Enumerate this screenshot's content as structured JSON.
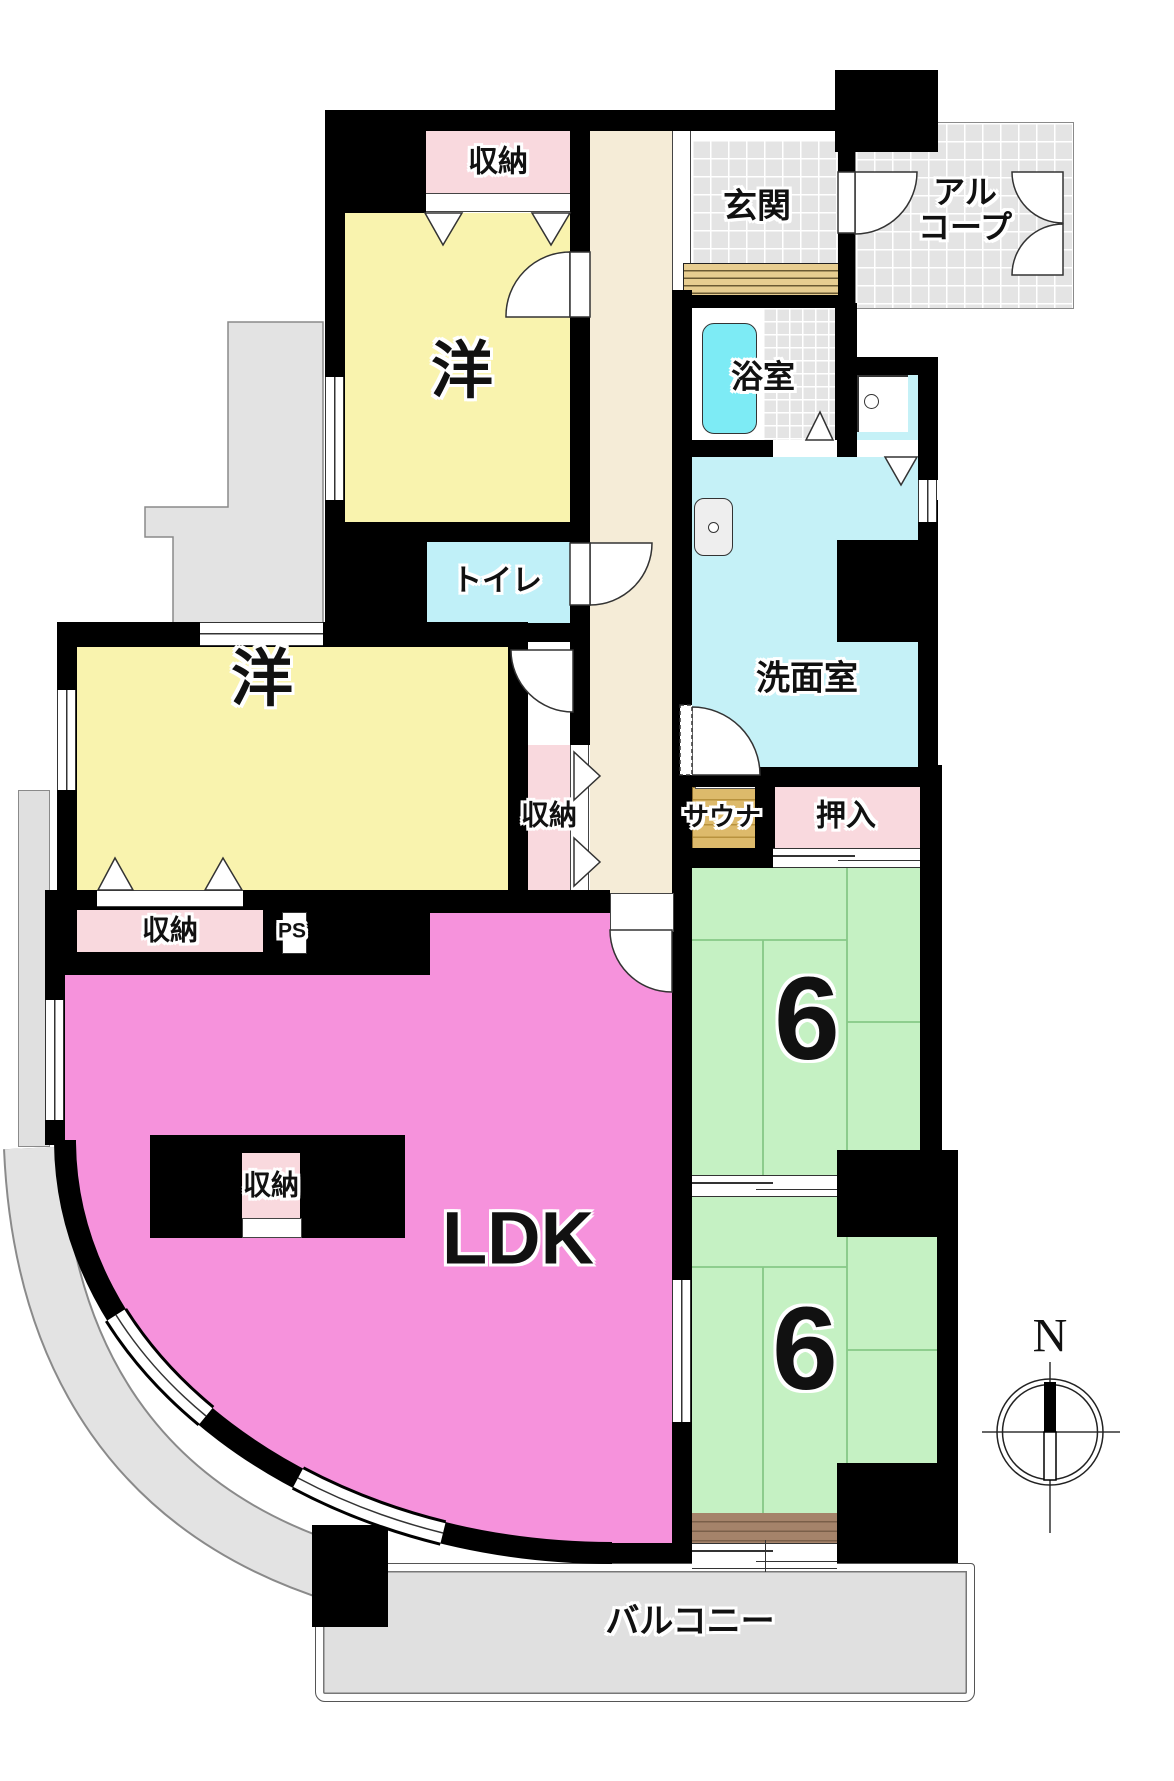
{
  "title": "マンション間取り図 (apartment floor plan)",
  "compass": {
    "label": "N"
  },
  "rooms": {
    "storage_top": {
      "label": "収納"
    },
    "western_north": {
      "label": "洋"
    },
    "entrance": {
      "label": "玄関"
    },
    "alcove": {
      "label_line1": "アル",
      "label_line2": "コープ"
    },
    "bathroom": {
      "label": "浴室"
    },
    "toilet": {
      "label": "トイレ"
    },
    "washroom": {
      "label": "洗面室"
    },
    "sauna": {
      "label": "サウナ"
    },
    "oshiire": {
      "label": "押入"
    },
    "storage_west_wall": {
      "label": "収納"
    },
    "western_center": {
      "label": "洋"
    },
    "storage_south": {
      "label": "収納"
    },
    "pipe_space": {
      "label": "PS"
    },
    "storage_ldk": {
      "label": "収納"
    },
    "ldk": {
      "label": "LDK"
    },
    "tatami_north": {
      "label": "6",
      "tatami_mats": 6
    },
    "tatami_south": {
      "label": "6",
      "tatami_mats": 6
    },
    "balcony": {
      "label": "バルコニー"
    }
  },
  "colors": {
    "wall": "#000000",
    "western": "#f9f3ae",
    "storage": "#f9d9de",
    "ldk": "#f692dc",
    "tatami": "#c5f1c3",
    "washroom": "#c5f1f7",
    "toilet": "#c0f0f8",
    "tub": "#7debf5",
    "hallway": "#f5ecd7",
    "tile": "#e4e4e4",
    "sauna_a": "#ddba6b",
    "sauna_b": "#b8923e",
    "step_a": "#e7cd90",
    "step_b": "#6b5a33",
    "brown_a": "#a5836a",
    "brown_b": "#7a5f49",
    "balcony": "#e0e0e0",
    "mat_line": "#86c886"
  }
}
